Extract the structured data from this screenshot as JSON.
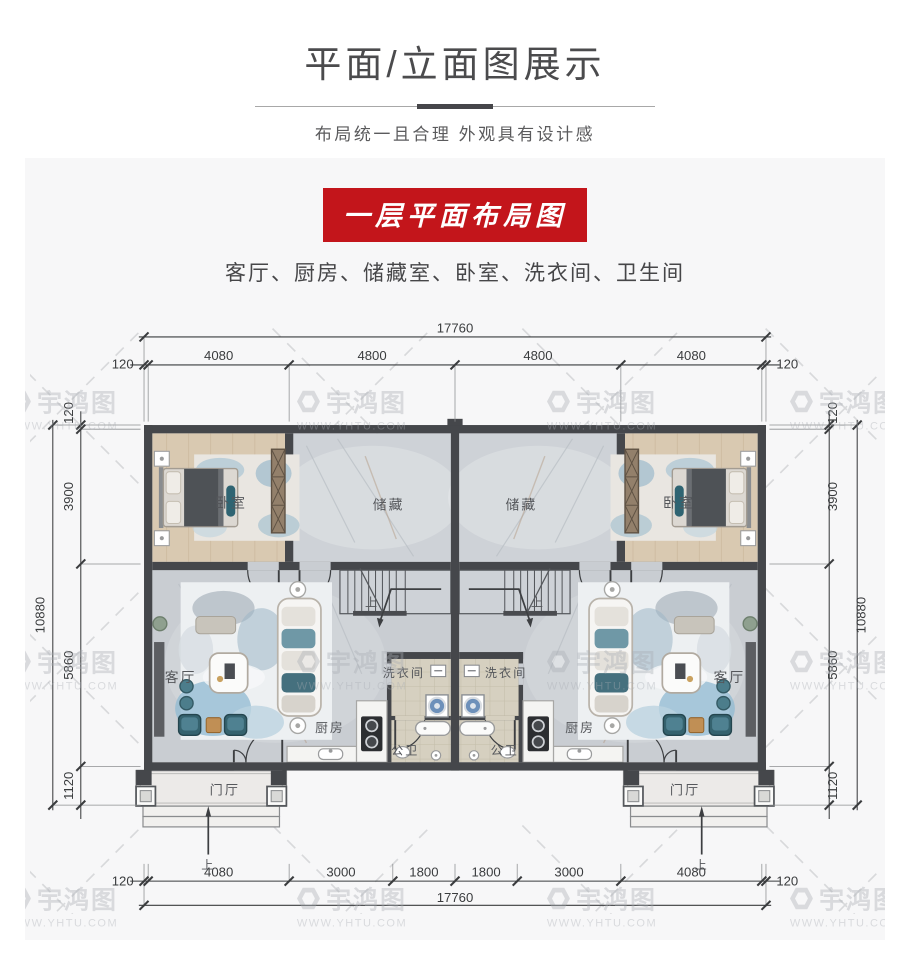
{
  "page": {
    "title": "平面/立面图展示",
    "subtitle": "布局统一且合理 外观具有设计感",
    "banner": "一层平面布局图",
    "room_list": "客厅、厨房、储藏室、卧室、洗衣间、卫生间"
  },
  "watermark": {
    "brand": "宇鸿图",
    "url": "WWW.YHTU.COM"
  },
  "colors": {
    "banner_red": "#c3151b",
    "wall": "#45474b",
    "marble_floor": "#cbcfd4",
    "wood_floor": "#d9c9b1",
    "teal_furniture": "#3f7280"
  },
  "plan": {
    "dims": {
      "top_total": "17760",
      "top": [
        "120",
        "4080",
        "4800",
        "4800",
        "4080",
        "120"
      ],
      "bottom": [
        "120",
        "4080",
        "3000",
        "1800",
        "1800",
        "3000",
        "4080",
        "120"
      ],
      "bottom_total": "17760",
      "left_total": "10880",
      "left": [
        "120",
        "3900",
        "5860",
        "1120"
      ],
      "right_total": "10880",
      "right": [
        "120",
        "3900",
        "5860",
        "1120"
      ]
    },
    "labels": {
      "bedroom": "卧室",
      "storage": "储藏",
      "living": "客厅",
      "kitchen": "厨房",
      "laundry": "洗衣间",
      "bath": "公卫",
      "foyer": "门厅",
      "up": "上"
    }
  }
}
